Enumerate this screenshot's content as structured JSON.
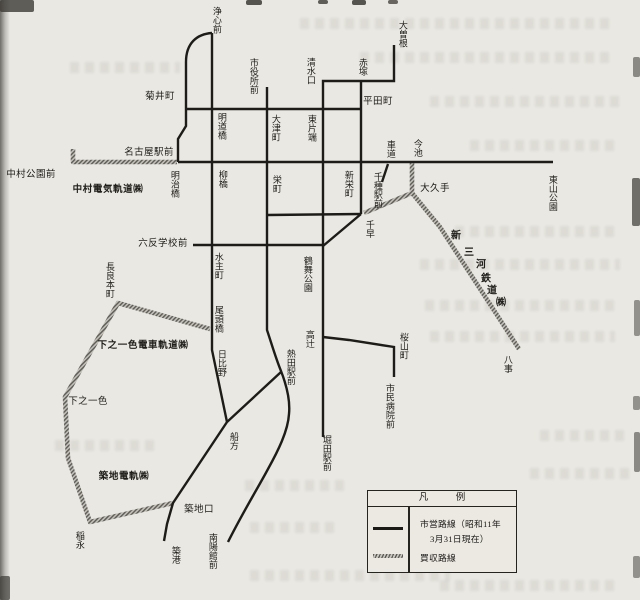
{
  "palette": {
    "paper": "#eae8e2",
    "ink": "#1e1c18",
    "hatch_light": "#c3c1ba",
    "hatch_dark": "#5d5b55"
  },
  "map": {
    "routes_solid": [
      {
        "id": "joshin-loop",
        "d": "M212,33 C197,34 186,43 186,62 L186,126 L178,139 L178,162"
      },
      {
        "id": "nishi-trunk",
        "d": "M212,33 L212,350 L227,422"
      },
      {
        "id": "kikuicho-line",
        "d": "M186,109 L361,109"
      },
      {
        "id": "hirokoji-main",
        "d": "M178,162 L553,162"
      },
      {
        "id": "ozone-horita",
        "d": "M394,45 L394,81 L323,81 L323,437"
      },
      {
        "id": "shiyakusho-atsuta-nanyo",
        "d": "M267,87 L267,330 C272,345 276,359 281,371 C288,389 290,404 289,414 C288,431 278,451 268,469 C259,486 243,512 228,542"
      },
      {
        "id": "hirata-chikusa",
        "d": "M361,81 L361,214"
      },
      {
        "id": "sakae-shinsakae",
        "d": "M267,215 L361,214"
      },
      {
        "id": "chihaya-diagonal",
        "d": "M361,214 L323,246"
      },
      {
        "id": "rokutan-line",
        "d": "M193,245 L323,245"
      },
      {
        "id": "takatsuji-sakurayama",
        "d": "M323,337 L349,340 L394,347 L394,377"
      },
      {
        "id": "funakata-chikko",
        "d": "M281,372 L227,422 L173,503 L167,524 L164,541"
      },
      {
        "id": "kurumamichi-tick",
        "d": "M388,164 L382,182"
      }
    ],
    "routes_hatched": [
      {
        "id": "nakamura-railway",
        "d": "M73,149 L73,162 L177,162"
      },
      {
        "id": "imaike-stem",
        "d": "M412,162 L412,193"
      },
      {
        "id": "imaike-chikusa-branch",
        "d": "M412,193 L364,213"
      },
      {
        "id": "shin-mikawa-line",
        "d": "M412,193 L440,227 L519,349"
      },
      {
        "id": "shimonoisshiki-line",
        "d": "M210,329 L118,303 L65,397 L68,458 L90,522 L173,503"
      }
    ],
    "stations": [
      {
        "label": "浄心前",
        "x": 216,
        "y": 20,
        "dir": "v"
      },
      {
        "label": "菊井町",
        "x": 160,
        "y": 97,
        "dir": "h"
      },
      {
        "label": "市役所前",
        "x": 253,
        "y": 76,
        "dir": "v"
      },
      {
        "label": "清水口",
        "x": 310,
        "y": 71,
        "dir": "v"
      },
      {
        "label": "赤塚",
        "x": 362,
        "y": 67,
        "dir": "v"
      },
      {
        "label": "大曽根",
        "x": 402,
        "y": 34,
        "dir": "v"
      },
      {
        "label": "明道橋",
        "x": 221,
        "y": 126,
        "dir": "v"
      },
      {
        "label": "大津町",
        "x": 275,
        "y": 128,
        "dir": "v"
      },
      {
        "label": "東片端",
        "x": 311,
        "y": 128,
        "dir": "v"
      },
      {
        "label": "平田町",
        "x": 378,
        "y": 102,
        "dir": "h"
      },
      {
        "label": "車道",
        "x": 390,
        "y": 149,
        "dir": "v"
      },
      {
        "label": "今池",
        "x": 417,
        "y": 148,
        "dir": "v"
      },
      {
        "label": "名古屋駅前",
        "x": 149,
        "y": 153,
        "dir": "h"
      },
      {
        "label": "中村公園前",
        "x": 31,
        "y": 175,
        "dir": "h"
      },
      {
        "label": "明治橋",
        "x": 174,
        "y": 184,
        "dir": "v"
      },
      {
        "label": "柳橋",
        "x": 222,
        "y": 179,
        "dir": "v"
      },
      {
        "label": "栄町",
        "x": 276,
        "y": 184,
        "dir": "v"
      },
      {
        "label": "新栄町",
        "x": 348,
        "y": 184,
        "dir": "v"
      },
      {
        "label": "千種駅前",
        "x": 377,
        "y": 190,
        "dir": "v"
      },
      {
        "label": "大久手",
        "x": 435,
        "y": 189,
        "dir": "h"
      },
      {
        "label": "東山公園",
        "x": 552,
        "y": 193,
        "dir": "v"
      },
      {
        "label": "千早",
        "x": 369,
        "y": 229,
        "dir": "v"
      },
      {
        "label": "六反学校前",
        "x": 163,
        "y": 244,
        "dir": "h"
      },
      {
        "label": "水主町",
        "x": 218,
        "y": 266,
        "dir": "v"
      },
      {
        "label": "鶴舞公園",
        "x": 307,
        "y": 274,
        "dir": "v"
      },
      {
        "label": "長良本町",
        "x": 109,
        "y": 280,
        "dir": "v"
      },
      {
        "label": "尾頭橋",
        "x": 218,
        "y": 319,
        "dir": "v"
      },
      {
        "label": "高辻",
        "x": 309,
        "y": 339,
        "dir": "v"
      },
      {
        "label": "桜山町",
        "x": 403,
        "y": 346,
        "dir": "v"
      },
      {
        "label": "八事",
        "x": 507,
        "y": 364,
        "dir": "v"
      },
      {
        "label": "日比野",
        "x": 221,
        "y": 363,
        "dir": "v"
      },
      {
        "label": "熱田駅前",
        "x": 290,
        "y": 367,
        "dir": "v"
      },
      {
        "label": "市民病院前",
        "x": 389,
        "y": 406,
        "dir": "v"
      },
      {
        "label": "下之一色",
        "x": 88,
        "y": 402,
        "dir": "h"
      },
      {
        "label": "船方",
        "x": 233,
        "y": 441,
        "dir": "v"
      },
      {
        "label": "堀田駅前",
        "x": 326,
        "y": 453,
        "dir": "v"
      },
      {
        "label": "築地口",
        "x": 199,
        "y": 510,
        "dir": "h"
      },
      {
        "label": "稲永",
        "x": 79,
        "y": 540,
        "dir": "v"
      },
      {
        "label": "築港",
        "x": 175,
        "y": 555,
        "dir": "v"
      },
      {
        "label": "南陽館前",
        "x": 212,
        "y": 551,
        "dir": "v"
      }
    ],
    "companies": [
      {
        "label": "中村電気軌道㈱",
        "x": 108,
        "y": 190
      },
      {
        "label": "下之一色電車軌道㈱",
        "x": 143,
        "y": 346
      },
      {
        "label": "築地電軌㈱",
        "x": 124,
        "y": 477
      }
    ],
    "diagonal_company": {
      "label": "新三河鉄道㈱",
      "chars": [
        {
          "ch": "新",
          "x": 456,
          "y": 237
        },
        {
          "ch": "三",
          "x": 469,
          "y": 254
        },
        {
          "ch": "河",
          "x": 481,
          "y": 266
        },
        {
          "ch": "鉄",
          "x": 486,
          "y": 280
        },
        {
          "ch": "道",
          "x": 492,
          "y": 292
        },
        {
          "ch": "㈱",
          "x": 501,
          "y": 304
        }
      ]
    }
  },
  "legend": {
    "title": "凡　例",
    "items": [
      {
        "style": "solid",
        "line1": "市営路線（昭和11年",
        "line2": "3月31日現在）"
      },
      {
        "style": "hatched",
        "line1": "買収路線"
      }
    ]
  }
}
